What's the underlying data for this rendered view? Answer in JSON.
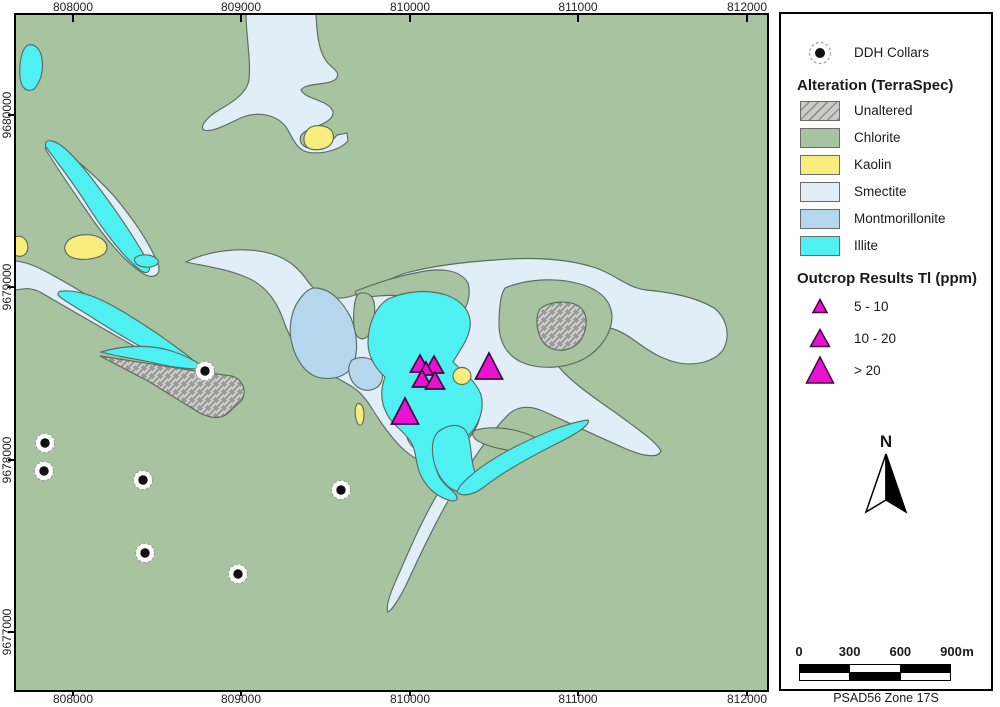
{
  "colors": {
    "chlorite": "#a7c3a0",
    "smectite": "#e2eef7",
    "montmorillonite": "#b4d7ee",
    "illite": "#4ff0f2",
    "kaolin": "#f8ec7c",
    "unaltered_bg": "#cbcbc9",
    "unaltered_line": "#8e8e8e",
    "outline": "#5c6b60",
    "triangle_fill": "#e912d2",
    "triangle_stroke": "#3c083c",
    "collar_dot": "#101010",
    "collar_ring": "#9b9b9b",
    "frame": "#000000"
  },
  "axes": {
    "x_ticks": [
      {
        "label": "808000",
        "px": 73
      },
      {
        "label": "809000",
        "px": 241
      },
      {
        "label": "810000",
        "px": 410
      },
      {
        "label": "811000",
        "px": 578
      },
      {
        "label": "812000",
        "px": 747
      }
    ],
    "y_ticks": [
      {
        "label": "9680000",
        "px": 115
      },
      {
        "label": "9679000",
        "px": 287
      },
      {
        "label": "9678000",
        "px": 460
      },
      {
        "label": "9677000",
        "px": 632
      }
    ]
  },
  "legend": {
    "ddh_label": "DDH Collars",
    "alteration_title": "Alteration (TerraSpec)",
    "alteration_items": [
      {
        "name": "unaltered",
        "label": "Unaltered",
        "fill": "unaltered"
      },
      {
        "name": "chlorite",
        "label": "Chlorite",
        "fill": "chlorite"
      },
      {
        "name": "kaolin",
        "label": "Kaolin",
        "fill": "kaolin"
      },
      {
        "name": "smectite",
        "label": "Smectite",
        "fill": "smectite"
      },
      {
        "name": "montmorillonite",
        "label": "Montmorillonite",
        "fill": "montmorillonite"
      },
      {
        "name": "illite",
        "label": "Illite",
        "fill": "illite"
      }
    ],
    "outcrop_title": "Outcrop Results Tl (ppm)",
    "outcrop_items": [
      {
        "label": "5 - 10",
        "size": "small"
      },
      {
        "label": "10 - 20",
        "size": "medium"
      },
      {
        "label": "> 20",
        "size": "large"
      }
    ]
  },
  "north_label": "N",
  "scalebar": {
    "labels": [
      "0",
      "300",
      "600",
      "900"
    ],
    "unit": "m",
    "rows": [
      [
        "black",
        "white",
        "black"
      ],
      [
        "white",
        "black",
        "white"
      ]
    ],
    "datum": "PSAD56 Zone 17S"
  },
  "map": {
    "background_fill": "chlorite",
    "triangle_sizes": {
      "small": {
        "w": 14,
        "h": 13
      },
      "medium": {
        "w": 19,
        "h": 17
      },
      "large": {
        "w": 27,
        "h": 26
      }
    },
    "regions": [
      {
        "name": "smectite-top-center",
        "fill": "smectite",
        "path": "M246,14 L316,14 C317,36 319,52 327,62 C334,70 341,72 336,79 C328,86 306,82 301,90 C306,100 330,100 333,112 C334,122 316,126 306,131 C297,136 299,145 308,148 C319,151 331,143 337,135 L347,133 L348,141 C340,150 321,155 307,152 C296,149 293,138 286,127 C277,115 259,111 243,117 C229,123 213,133 204,130 C199,127 207,117 219,110 C235,101 247,92 249,80 C251,60 246,34 246,14 Z"
      },
      {
        "name": "kaolin-top-center",
        "fill": "kaolin",
        "path": "M306,146 C302,140 304,131 311,127 C318,124 327,126 331,130 C335,135 334,142 329,146 C322,151 310,151 306,146 Z"
      },
      {
        "name": "illite-top-left-lens",
        "fill": "illite",
        "path": "M28,45 C35,43 41,50 42,59 C44,71 40,83 34,89 C27,93 21,88 20,77 C19,65 21,49 28,45 Z"
      },
      {
        "name": "smectite-west-halo",
        "fill": "smectite",
        "path": "M55,146 C70,154 92,172 114,196 C134,220 150,244 158,264 C162,274 154,280 144,274 C124,262 102,234 86,210 C68,184 52,160 46,150 C44,144 50,143 55,146 Z"
      },
      {
        "name": "illite-west-lens",
        "fill": "illite",
        "path": "M52,141 C62,143 78,160 96,184 C116,210 136,240 148,262 C152,270 148,276 140,270 C122,256 100,226 84,200 C67,174 50,153 46,147 C44,142 47,140 52,141 Z"
      },
      {
        "name": "kaolin-west",
        "fill": "kaolin",
        "path": "M67,242 C72,234 92,232 102,239 C110,245 108,254 98,257 C86,261 72,260 67,254 C64,250 64,246 67,242 Z"
      },
      {
        "name": "kaolin-west-edge",
        "fill": "kaolin",
        "path": "M15,237 C22,234 28,240 28,248 C27,256 20,258 15,255 Z"
      },
      {
        "name": "smectite-west-band",
        "fill": "smectite",
        "path": "M15,261 C28,262 40,268 54,276 C76,288 112,310 142,330 C168,347 192,362 206,368 C212,371 213,376 206,376 C188,374 162,362 134,346 C102,328 64,306 40,292 C28,286 20,290 15,290 Z"
      },
      {
        "name": "illite-west-blob",
        "fill": "illite",
        "path": "M136,257 C144,253 154,255 158,260 C160,265 152,268 144,267 C136,266 132,260 136,257 Z"
      },
      {
        "name": "illite-west-band",
        "fill": "illite",
        "path": "M64,291 C80,290 100,298 120,310 C144,324 170,342 188,356 C198,364 203,369 206,371 C198,373 184,369 168,361 C146,350 118,334 96,320 C78,308 62,300 58,295 C58,291 60,291 64,291 Z"
      },
      {
        "name": "smectite-central",
        "fill": "smectite",
        "path": "M186,262 C210,250 245,246 272,254 C291,260 301,271 309,283 C320,297 336,301 352,296 C372,290 386,279 406,273 C432,266 464,262 495,260 C530,257 566,258 596,268 C616,275 628,288 646,290 C668,292 696,297 714,308 C727,318 731,336 723,350 C714,362 694,367 675,362 C655,357 640,344 628,336 C610,325 596,324 580,331 C567,337 559,350 556,363 C566,378 590,395 616,413 C636,428 656,441 661,451 C658,459 642,456 624,448 C599,437 569,423 545,412 C530,405 519,406 510,413 C494,428 477,453 461,479 C444,506 424,546 408,581 C399,600 391,611 388,612 C385,605 392,589 401,569 C413,541 428,508 442,487 C448,477 446,470 437,468 C424,464 411,457 401,447 C389,435 379,420 371,407 C364,396 358,390 351,386 C338,378 324,372 314,364 C299,353 290,339 284,322 C278,304 268,287 248,278 C228,269 204,266 186,262 Z"
      },
      {
        "name": "chlorite-island-peninsula",
        "fill": "chlorite",
        "path": "M356,291 C376,283 398,276 420,272 C444,267 461,271 468,283 C472,296 466,311 456,323 C448,333 440,336 434,330 C427,322 429,310 421,303 C409,293 384,295 369,297 C360,298 353,294 356,291 Z"
      },
      {
        "name": "chlorite-island-ring",
        "fill": "chlorite",
        "path": "M505,288 C526,279 556,277 580,284 C601,290 611,301 612,316 C612,333 601,349 584,359 C564,369 539,370 521,362 C507,355 499,342 499,325 C499,310 500,295 505,288 Z"
      },
      {
        "name": "chlorite-sliver-central",
        "fill": "chlorite",
        "path": "M358,294 C365,291 372,294 374,302 C376,315 374,328 368,336 C362,342 355,338 354,327 C353,314 354,299 358,294 Z"
      },
      {
        "name": "montmorillonite-west-lobe",
        "fill": "montmorillonite",
        "path": "M316,288 C331,289 343,302 351,318 C357,333 359,351 353,365 C347,377 331,381 317,377 C305,373 296,360 292,344 C288,329 291,311 299,300 C304,293 310,287 316,288 Z"
      },
      {
        "name": "montmorillonite-south-patch",
        "fill": "montmorillonite",
        "path": "M352,360 C362,355 373,358 379,366 C385,375 383,385 374,389 C365,393 355,388 351,379 C348,372 348,365 352,360 Z"
      },
      {
        "name": "montmorillonite-south-band",
        "fill": "montmorillonite",
        "path": "M410,420 C420,403 434,394 450,391 C464,389 474,396 479,405 C483,416 477,429 468,439 C458,449 448,453 438,457 C427,459 415,452 409,442 C405,435 406,428 410,420 Z"
      },
      {
        "name": "illite-central",
        "fill": "illite",
        "path": "M388,299 C406,291 427,289 446,295 C463,301 472,313 470,327 C468,341 459,351 453,362 C463,372 476,381 481,395 C485,411 478,427 466,438 C455,448 444,448 438,458 C432,470 441,481 450,489 C458,495 460,501 452,501 C438,498 427,488 421,476 C415,464 417,452 411,442 C403,430 391,424 386,412 C380,400 381,388 385,377 C375,368 368,356 368,343 C368,325 375,307 388,299 Z"
      },
      {
        "name": "chlorite-island-south",
        "fill": "chlorite",
        "path": "M476,430 C495,425 520,429 538,439 C545,444 542,452 532,452 C512,452 490,448 478,441 C472,437 471,432 476,430 Z"
      },
      {
        "name": "illite-south-blob",
        "fill": "illite",
        "path": "M438,432 C448,424 460,423 466,431 C472,441 470,457 474,469 C478,482 472,492 460,492 C448,490 438,478 434,462 C431,448 432,438 438,432 Z"
      },
      {
        "name": "illite-tail-streak",
        "fill": "illite",
        "path": "M460,486 C478,466 506,450 538,436 C558,427 578,421 588,420 C591,424 578,433 558,443 C532,456 504,471 484,487 C471,497 459,496 457,492 Z"
      },
      {
        "name": "illite-wedge-sliver",
        "fill": "illite",
        "path": "M101,352 C121,346 146,344 168,350 C185,355 198,362 204,368 C195,370 177,368 159,364 C137,359 114,356 101,352 Z"
      },
      {
        "name": "kaolin-central-dot",
        "fill": "kaolin",
        "path": "M453,376 a9,8.5 0 1 0 18,0 a9,8.5 0 1 0 -18,0 Z"
      },
      {
        "name": "kaolin-central-sliver",
        "fill": "kaolin",
        "path": "M357,404 C361,402 364,407 364,415 C364,423 361,428 358,424 C355,419 354,408 357,404 Z"
      },
      {
        "name": "unaltered-wedge",
        "fill": "unaltered",
        "path": "M100,356 L196,371 L232,376 C243,380 247,390 242,400 L227,414 C219,420 207,418 195,410 L148,381 Z"
      },
      {
        "name": "unaltered-knob",
        "fill": "unaltered",
        "path": "M540,309 C549,301 571,299 581,308 C589,316 587,331 580,341 C572,351 557,353 547,346 C537,338 534,319 540,309 Z"
      }
    ],
    "collars": [
      [
        205,
        371
      ],
      [
        45,
        443
      ],
      [
        44,
        471
      ],
      [
        143,
        480
      ],
      [
        341,
        490
      ],
      [
        145,
        553
      ],
      [
        238,
        574
      ]
    ],
    "triangles": [
      {
        "x": 420,
        "y": 355,
        "size": "medium"
      },
      {
        "x": 434,
        "y": 356,
        "size": "medium"
      },
      {
        "x": 426,
        "y": 362,
        "size": "small"
      },
      {
        "x": 422,
        "y": 370,
        "size": "medium"
      },
      {
        "x": 435,
        "y": 372,
        "size": "medium"
      },
      {
        "x": 405,
        "y": 398,
        "size": "large"
      },
      {
        "x": 489,
        "y": 353,
        "size": "large"
      }
    ]
  }
}
